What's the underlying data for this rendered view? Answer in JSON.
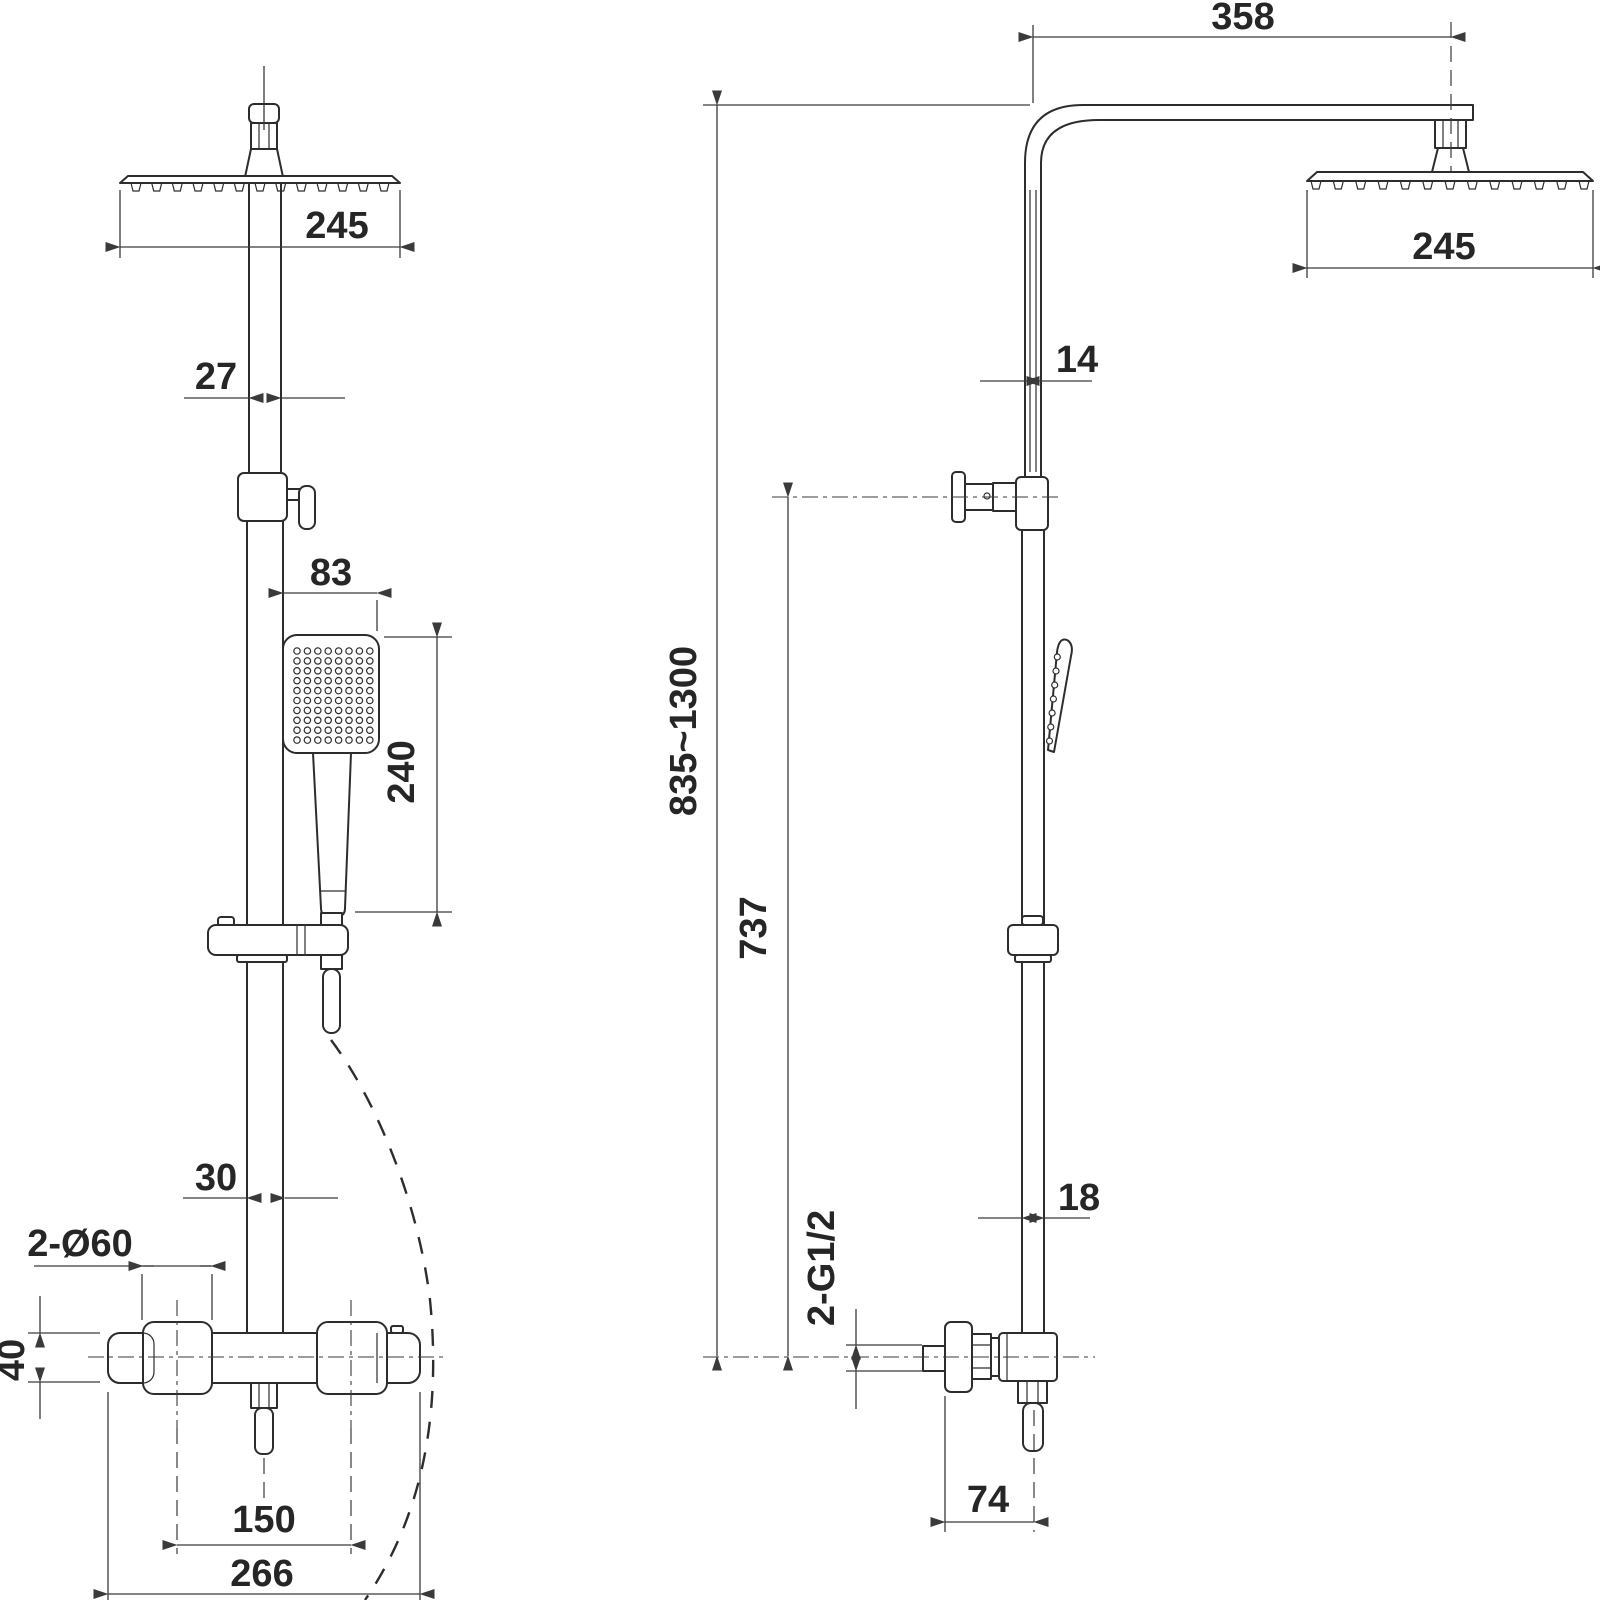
{
  "colors": {
    "line": "#2d2d2d",
    "dim": "#3a3a3a",
    "text": "#262626",
    "background": "#ffffff"
  },
  "front_view": {
    "dims": {
      "head_width": "245",
      "pipe_upper": "27",
      "hand_shower_width": "83",
      "hand_shower_length": "240",
      "pipe_lower": "30",
      "mount_holes": "2-Ø60",
      "valve_height": "40",
      "inlet_spacing": "150",
      "valve_width": "266"
    }
  },
  "side_view": {
    "dims": {
      "arm_reach": "358",
      "head_depth": "245",
      "pipe_upper": "14",
      "total_height": "835~1300",
      "bracket_height": "737",
      "pipe_lower": "18",
      "inlet_thread": "2-G1/2",
      "valve_depth": "74"
    }
  }
}
